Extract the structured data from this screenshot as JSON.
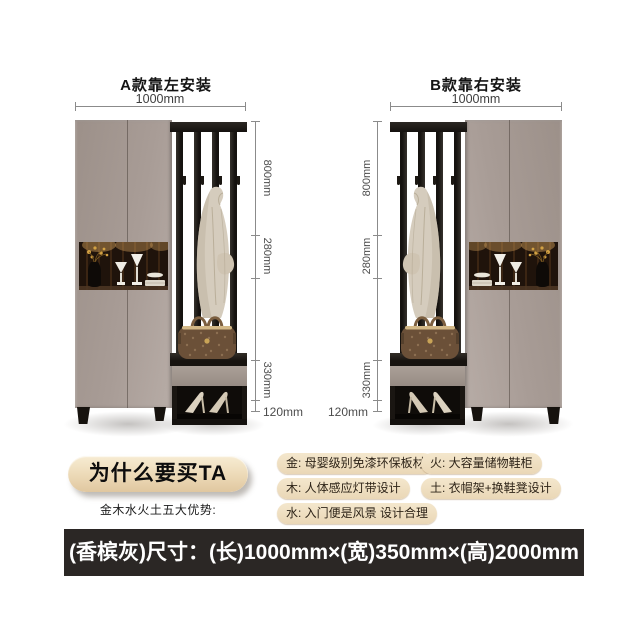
{
  "panels": [
    {
      "id": "A",
      "title": "A款靠左安装",
      "width_label": "1000mm",
      "height_labels": {
        "top": "800mm",
        "mid": "280mm",
        "lower": "330mm",
        "bottom": "120mm"
      }
    },
    {
      "id": "B",
      "title": "B款靠右安装",
      "width_label": "1000mm",
      "height_labels": {
        "top": "800mm",
        "mid": "280mm",
        "lower": "330mm",
        "bottom": "120mm"
      }
    }
  ],
  "why_buy": {
    "pill_label": "为什么要买TA",
    "subtitle": "金木水火土五大优势:"
  },
  "features": [
    {
      "label": "金: 母婴级别免漆环保板材"
    },
    {
      "label": "木: 人体感应灯带设计"
    },
    {
      "label": "水: 入门便是风景 设计合理"
    },
    {
      "label": "火: 大容量储物鞋柜"
    },
    {
      "label": "土: 衣帽架+换鞋凳设计"
    }
  ],
  "footer": {
    "size_text": "(香槟灰)尺寸：(长)1000mm×(宽)350mm×(高)2000mm"
  },
  "colors": {
    "cabinet_gray": "#a89c96",
    "badge_beige": "#eeddc0",
    "footer_bg": "#2b2725",
    "wood_dark": "#17130f"
  }
}
